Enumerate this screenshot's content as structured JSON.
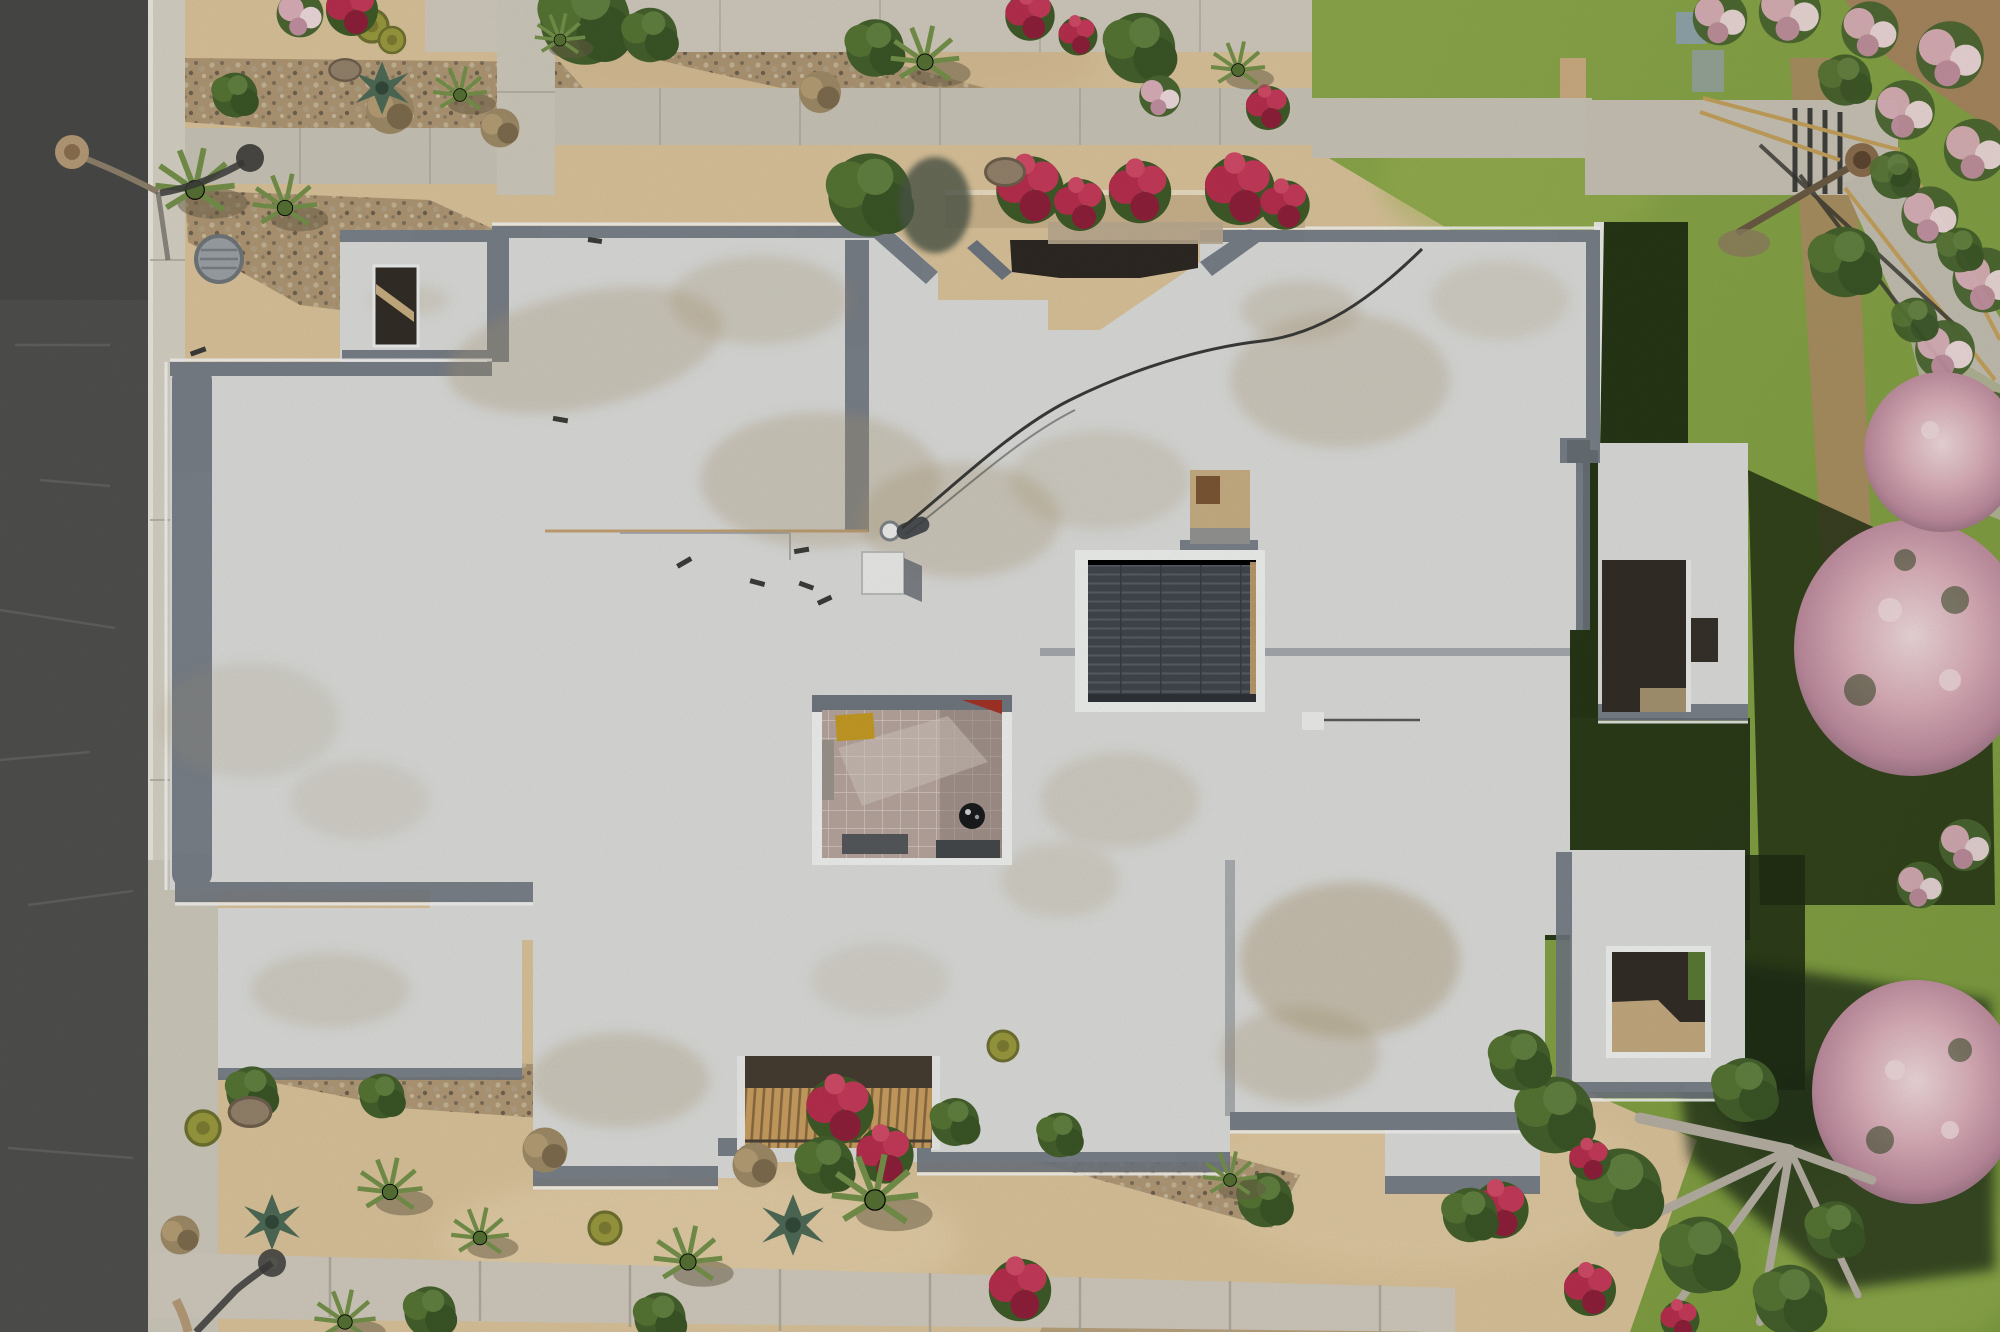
{
  "scene": {
    "description": "Overhead aerial drone photograph of a flat-roofed desert house: white roof volumes with gray parapet edging and dirt staining, a central tiled courtyard with a kettle grill, a dark louvered solar skylight, a shaded entry court with red bougainvillea planters, a wooden gate trellis at the bottom, desert sand with gravel bands, cacti and shrubs, an asphalt street with sidewalk on the left, and a lawn with pink flowering oleanders, stairs and a rail path on the right.",
    "objects": {
      "street": "asphalt street",
      "street_lamp": "street lamp",
      "manhole": "utility manhole cover",
      "house_roof": "white flat roof",
      "solar_skylight": "dark louvered skylight",
      "courtyard": "tiled interior courtyard",
      "grill": "kettle barbecue grill",
      "bench": "yellow bench",
      "entry_court": "shaded entry court",
      "gate_trellis": "wooden gate trellis",
      "pavilion": "detached pavilion",
      "casita": "rear casita with patio opening",
      "lawn": "lawn",
      "stairs": "garden stairs with wood rails",
      "oleanders": "pink flowering oleander trees",
      "fallen_tree": "sprawling gray-branched tree"
    }
  },
  "colors": {
    "road": "#4f4f4d",
    "road_dark": "#454544",
    "road_crack": "#646462",
    "curb": "#d5d0c3",
    "sidewalk": "#c8c3b6",
    "paver": "#cfc9bc",
    "paver_joint": "#a9a497",
    "sand": "#d9c29a",
    "sand_light": "#e6d2ac",
    "sand_dark": "#c2a67c",
    "gravel": "#a8916f",
    "grass": "#85a144",
    "grass_light": "#9cb455",
    "grass_shadow": "#1e2c12",
    "dirt": "#a5855d",
    "roof": "#dadbd9",
    "roof_bright": "#eff0ee",
    "roof_stain": "#a8946f",
    "parapet": "#6e757e",
    "seam": "#9aa1a8",
    "seam_tan": "#c2a071",
    "court_tile": "#b5a49c",
    "court_grout": "#d6cbc4",
    "court_shade": "#8b7c75",
    "solar": "#41464d",
    "solar_slat": "#575e66",
    "opening_dark": "#322d26",
    "entry_shadow": "#2d2822",
    "planter": "#c9b28c",
    "wood": "#c89e60",
    "wood_dark": "#8a6a40",
    "bench": "#c49a25",
    "grill": "#1a1b1d",
    "mat": "#54585a",
    "bloom_red": "#b52e4d",
    "bloom_red_dark": "#8e1f3a",
    "bloom_pink": "#d9aeb8",
    "bloom_pink_light": "#ecd8db",
    "hedge": "#44602c",
    "bush": "#567434",
    "branch": "#b5aea2",
    "manhole": "#9aa0a4",
    "lamp": "#b49a76",
    "shadow": "#3b3b39"
  }
}
